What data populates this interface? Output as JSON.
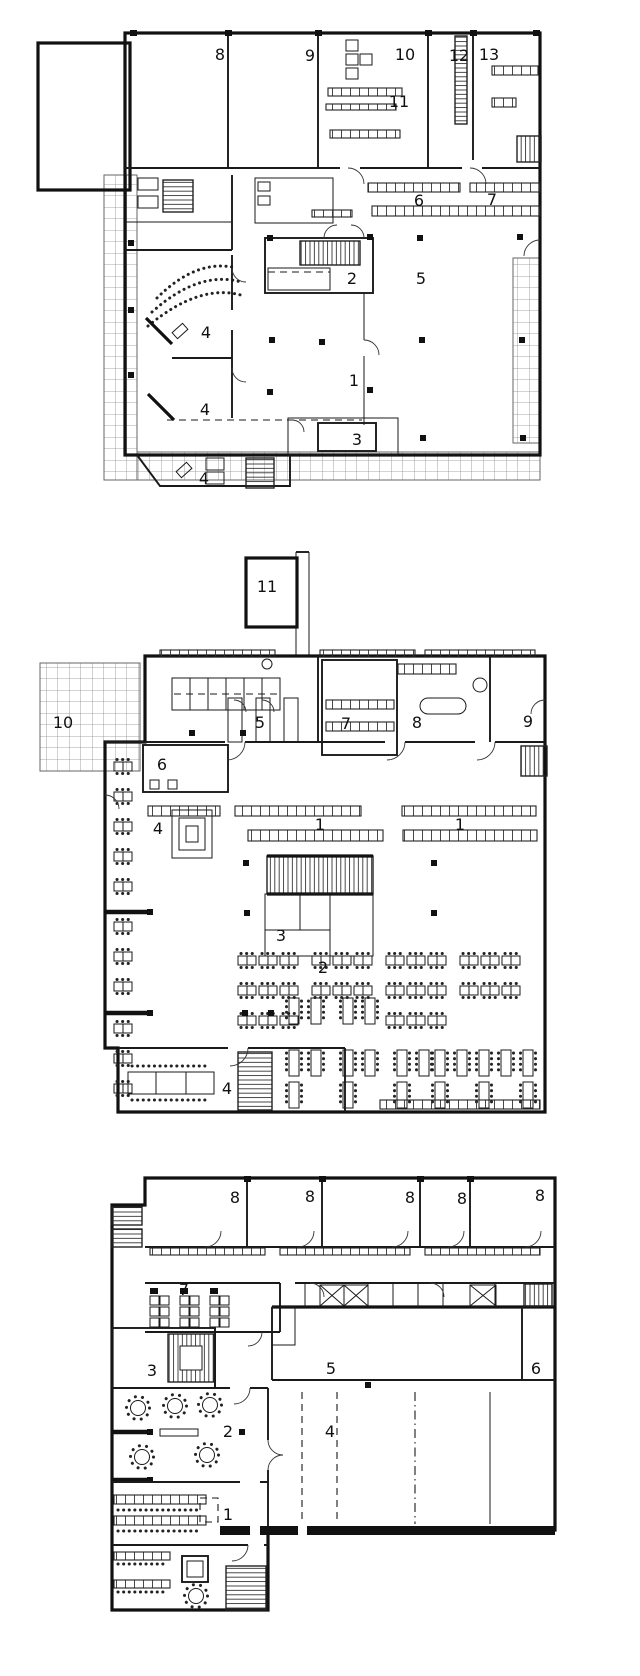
{
  "figure": {
    "type": "architectural-floor-plans",
    "colors": {
      "ink": "#111111",
      "grid": "#8a8a8a",
      "paper": "#ffffff"
    }
  },
  "plans": [
    {
      "id": "plan-top",
      "labels": [
        "8",
        "9",
        "10",
        "11",
        "12",
        "13",
        "6",
        "7",
        "2",
        "5",
        "4",
        "4",
        "4",
        "1",
        "3"
      ]
    },
    {
      "id": "plan-middle",
      "labels": [
        "11",
        "10",
        "5",
        "6",
        "7",
        "8",
        "9",
        "1",
        "1",
        "4",
        "3",
        "2",
        "4"
      ]
    },
    {
      "id": "plan-bottom",
      "labels": [
        "8",
        "8",
        "8",
        "8",
        "8",
        "7",
        "3",
        "5",
        "6",
        "2",
        "4",
        "1"
      ]
    }
  ]
}
